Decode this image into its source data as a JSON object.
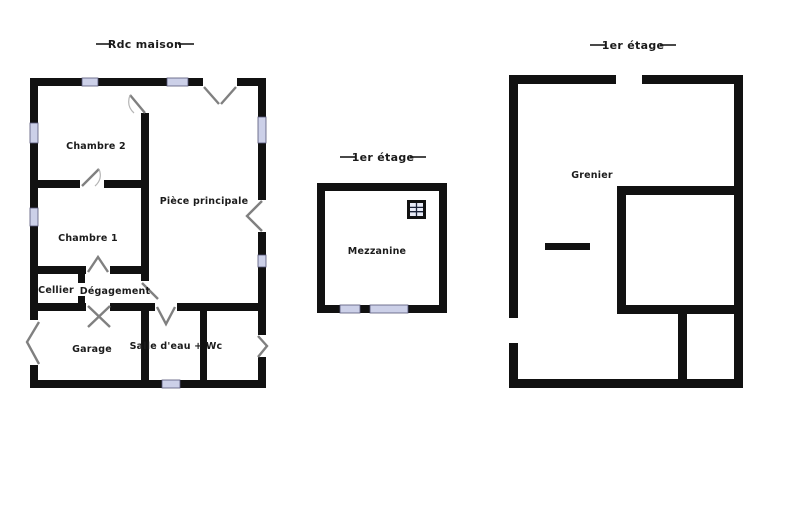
{
  "canvas": {
    "width": 791,
    "height": 527,
    "background": "#ffffff"
  },
  "colors": {
    "wall": "#111111",
    "window_fill": "#ccd0e8",
    "window_border": "#555577",
    "door_stroke": "#808080",
    "door_arc": "#b5b5b5",
    "label_color": "#1b1b1b",
    "skylight_frame": "#111111",
    "skylight_pane": "#e8ebf7"
  },
  "symbols": {
    "window": "lavender strip set into wall",
    "door": "gray diagonal swing leaf",
    "skylight": "framed grid roof-window"
  },
  "plans": [
    {
      "title": "Rdc maison",
      "rooms": [
        {
          "name": "Chambre 2"
        },
        {
          "name": "Pièce principale"
        },
        {
          "name": "Chambre 1"
        },
        {
          "name": "Cellier"
        },
        {
          "name": "Dégagement"
        },
        {
          "name": "Garage"
        },
        {
          "name": "Salle d'eau + Wc"
        }
      ]
    },
    {
      "title": "1er étage",
      "rooms": [
        {
          "name": "Mezzanine"
        }
      ],
      "icons": [
        {
          "name": "skylight-window-icon"
        }
      ]
    },
    {
      "title": "1er étage",
      "rooms": [
        {
          "name": "Grenier"
        }
      ]
    }
  ]
}
